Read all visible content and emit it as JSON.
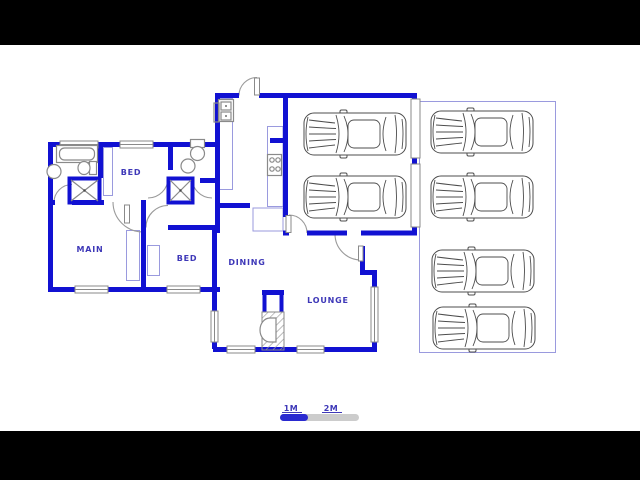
{
  "canvas": {
    "width": 640,
    "height": 480,
    "background": "#ffffff"
  },
  "letterbox": {
    "color": "#000000"
  },
  "colors": {
    "wall_blue": "#1111d2",
    "label_blue": "#3e38b8",
    "thin_blue": "#9a9ade",
    "fixture_grey": "#8a8a8a",
    "car_outline": "#4d4d4d",
    "scale_blue": "#2a2ad0",
    "scale_grey": "#cccccc"
  },
  "rooms": [
    {
      "id": "bed-1",
      "label": "BED",
      "x": 131,
      "y": 175
    },
    {
      "id": "main",
      "label": "MAIN",
      "x": 90,
      "y": 252
    },
    {
      "id": "bed-2",
      "label": "BED",
      "x": 187,
      "y": 261
    },
    {
      "id": "dining",
      "label": "DINING",
      "x": 247,
      "y": 265
    },
    {
      "id": "lounge",
      "label": "LOUNGE",
      "x": 328,
      "y": 303
    }
  ],
  "scale_bar": {
    "labels": [
      {
        "text": "1M",
        "x": 291
      },
      {
        "text": "2M",
        "x": 331
      }
    ]
  },
  "cars": {
    "garage": [
      {
        "x": 355,
        "y": 134
      },
      {
        "x": 355,
        "y": 197
      }
    ],
    "driveway": [
      {
        "x": 482,
        "y": 132
      },
      {
        "x": 482,
        "y": 197
      },
      {
        "x": 483,
        "y": 271
      },
      {
        "x": 484,
        "y": 328
      }
    ]
  },
  "icons": [
    "car-icon",
    "bathtub-icon",
    "wash-basin-icon",
    "toilet-icon",
    "shower-icon",
    "kitchen-sink-icon",
    "stove-icon",
    "fireplace-icon",
    "window-icon",
    "door-swing-icon"
  ]
}
